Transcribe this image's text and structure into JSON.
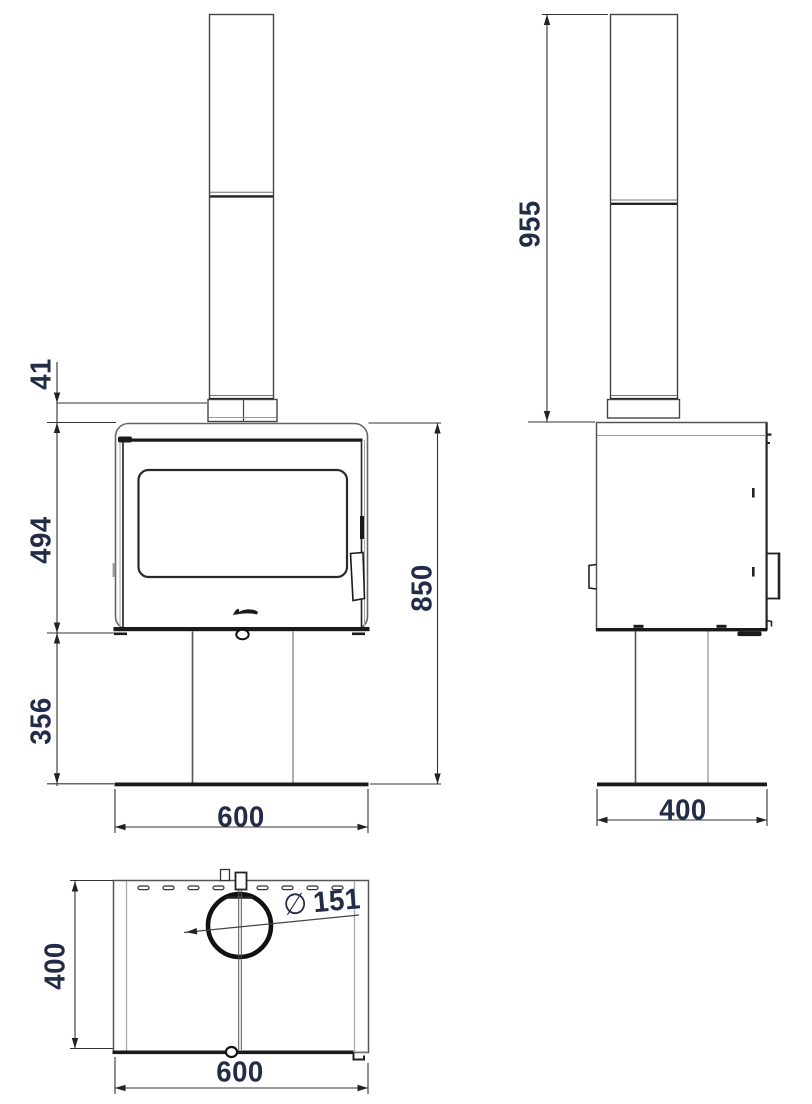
{
  "views": {
    "front": {
      "flue_top_offset": "41",
      "firebox_height": "494",
      "pedestal_height": "356",
      "overall_height": "850",
      "width": "600"
    },
    "side": {
      "flue_height": "955",
      "depth": "400"
    },
    "top": {
      "depth": "400",
      "width": "600",
      "diameter_symbol": "∅",
      "flue_diameter": "151"
    }
  },
  "colors": {
    "dimension_text": "#232c47",
    "line_dark": "#1a1a1a",
    "line_mid": "#444444",
    "line_light": "#999999"
  }
}
